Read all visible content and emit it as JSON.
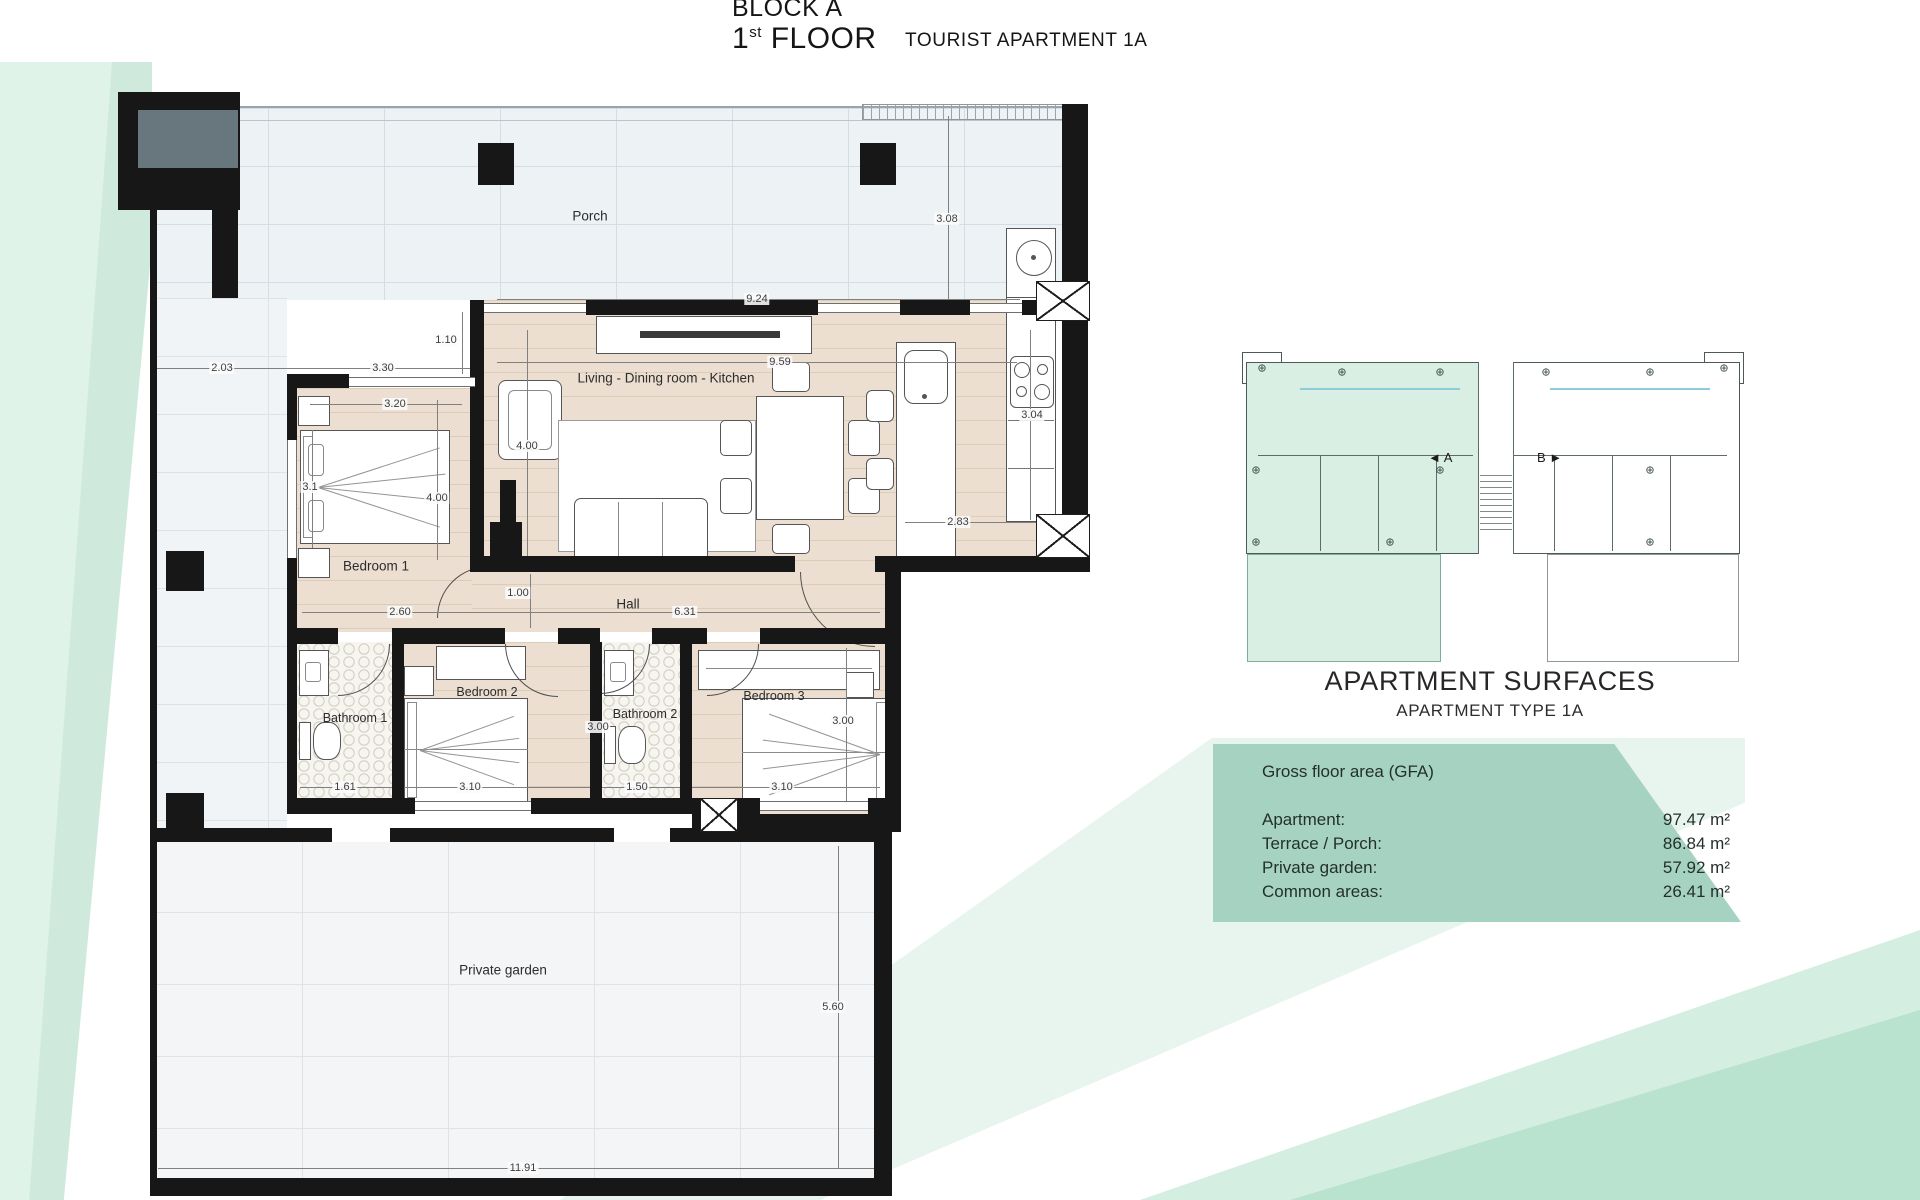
{
  "title": {
    "block": "BLOCK A",
    "floor_number": "1",
    "floor_ordinal": "st",
    "floor_word": " FLOOR",
    "apartment": "TOURIST APARTMENT 1A"
  },
  "plan": {
    "rooms": {
      "porch": "Porch",
      "living": "Living - Dining room - Kitchen",
      "bedroom1": "Bedroom 1",
      "hall": "Hall",
      "bathroom1": "Bathroom 1",
      "bedroom2": "Bedroom 2",
      "bathroom2": "Bathroom 2",
      "bedroom3": "Bedroom 3",
      "garden": "Private garden"
    },
    "dims": {
      "porch_width": "9.24",
      "porch_depth": "3.08",
      "terrace_left": "2.03",
      "bedroom1_top": "3.30",
      "offset_top": "1.10",
      "bedroom1_width": "3.20",
      "living_width": "9.59",
      "living_height": "4.00",
      "bedroom1_side": "3.1",
      "bedroom1_height": "4.00",
      "kitchen_depth": "3.04",
      "kitchen_bottom": "2.83",
      "bedroom1_bottom": "2.60",
      "hall_width": "1.00",
      "hall_length": "6.31",
      "bedroom2_height": "3.00",
      "bedroom3_height": "3.00",
      "bathroom1_width": "1.61",
      "bedroom2_width": "3.10",
      "bathroom2_width": "1.50",
      "bedroom3_width": "3.10",
      "garden_height": "5.60",
      "garden_width": "11.91"
    }
  },
  "key_plan": {
    "unit_a": "A",
    "unit_b": "B",
    "arrow_left": "◄",
    "arrow_right": "►",
    "marker": "⊕"
  },
  "surfaces": {
    "title": "APARTMENT SURFACES",
    "subtitle": "APARTMENT TYPE 1A",
    "gfa_header": "Gross floor area (GFA)",
    "rows": [
      {
        "label": "Apartment:",
        "value": "97.47 m²"
      },
      {
        "label": "Terrace / Porch:",
        "value": "86.84 m²"
      },
      {
        "label": "Private garden:",
        "value": "57.92 m²"
      },
      {
        "label": "Common areas:",
        "value": "26.41 m²"
      }
    ]
  },
  "colors": {
    "mint": "#a6d3c1",
    "mint_light": "#d9efe4",
    "wall": "#171717"
  }
}
